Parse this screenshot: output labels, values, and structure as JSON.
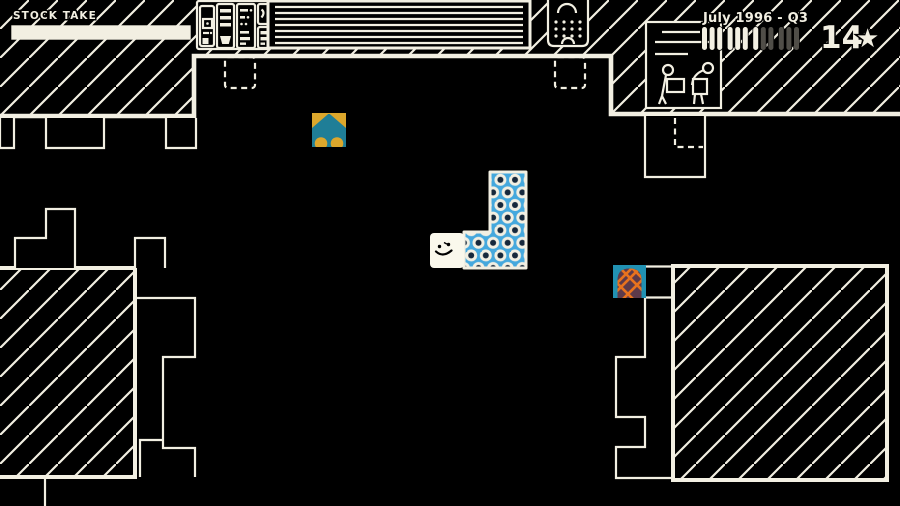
{
  "hud": {
    "stock_take": {
      "label": "STOCK TAKE",
      "progress_percent": 100
    },
    "calendar": {
      "date_label": "July 1996 - Q3",
      "months_total": 12,
      "months_elapsed": 7,
      "group_size": 3
    },
    "score": {
      "stars": "14",
      "star_glyph": "★"
    }
  },
  "scene": {
    "player": {
      "name": "Wilmot",
      "expression": "smiling-face"
    },
    "products": [
      {
        "name": "teal-arrow-on-gold-tile",
        "colors": [
          "#dca72c",
          "#1f7e97"
        ]
      },
      {
        "name": "blue-circle-pattern-L-block",
        "cells": 4,
        "colors": [
          "#45a8dd",
          "#f2efe2",
          "#16283c"
        ]
      },
      {
        "name": "orange-lattice-dome-tile",
        "colors": [
          "#2191b2",
          "#5d3a4a",
          "#e8731e"
        ]
      }
    ],
    "rooms": [
      "top-wall",
      "left-storage-room",
      "right-storage-room"
    ],
    "signs": [
      "workers-lifting-boxes-sign",
      "shutter-door",
      "shelf-console",
      "speaker-hatch"
    ]
  },
  "colors": {
    "ink": "#f2efe2",
    "background": "#000000",
    "tally_dim": "#504e48",
    "gold": "#dca72c",
    "teal": "#1f7e97",
    "pattern_blue": "#45a8dd",
    "pattern_navy": "#16283c",
    "tile_blue_border": "#2191b2",
    "dome_maroon": "#5d3a4a",
    "lattice_orange": "#e8731e"
  }
}
